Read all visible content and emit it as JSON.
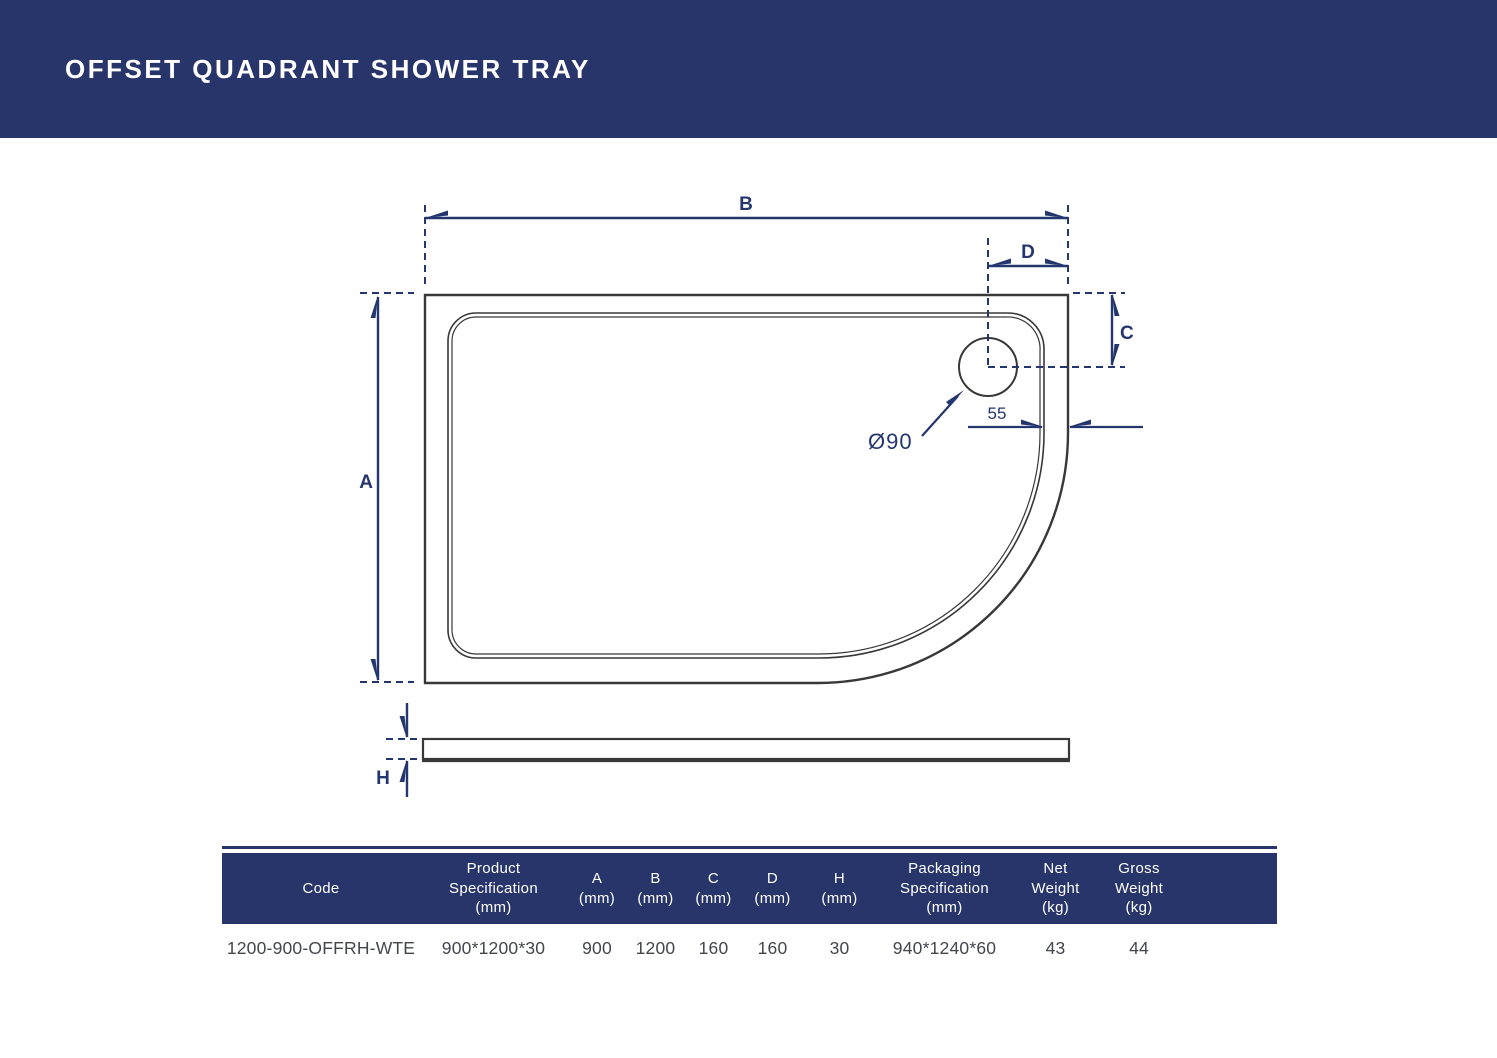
{
  "page": {
    "title": "OFFSET QUADRANT SHOWER TRAY"
  },
  "diagram": {
    "labels": {
      "b": "B",
      "d": "D",
      "c": "C",
      "a": "A",
      "h": "H",
      "drain_diameter": "Ø90",
      "drain_offset": "55"
    }
  },
  "table": {
    "columns": [
      {
        "label": "Code",
        "lines": [
          "Code"
        ]
      },
      {
        "label": "Product Specification (mm)",
        "lines": [
          "Product",
          "Specification",
          "(mm)"
        ]
      },
      {
        "label": "A (mm)",
        "lines": [
          "A",
          "(mm)"
        ]
      },
      {
        "label": "B (mm)",
        "lines": [
          "B",
          "(mm)"
        ]
      },
      {
        "label": "C (mm)",
        "lines": [
          "C",
          "(mm)"
        ]
      },
      {
        "label": "D (mm)",
        "lines": [
          "D",
          "(mm)"
        ]
      },
      {
        "label": "H (mm)",
        "lines": [
          "H",
          "(mm)"
        ]
      },
      {
        "label": "Packaging Specification (mm)",
        "lines": [
          "Packaging",
          "Specification",
          "(mm)"
        ]
      },
      {
        "label": "Net Weight (kg)",
        "lines": [
          "Net",
          "Weight",
          "(kg)"
        ]
      },
      {
        "label": "Gross Weight (kg)",
        "lines": [
          "Gross",
          "Weight",
          "(kg)"
        ]
      }
    ],
    "row": [
      "1200-900-OFFRH-WTE",
      "900*1200*30",
      "900",
      "1200",
      "160",
      "160",
      "30",
      "940*1240*60",
      "43",
      "44"
    ]
  },
  "colors": {
    "navy_block": "#28356a",
    "dimension_navy": "#24366e",
    "drawing_line": "#383838",
    "table_text": "#43464d",
    "background": "#ffffff"
  }
}
